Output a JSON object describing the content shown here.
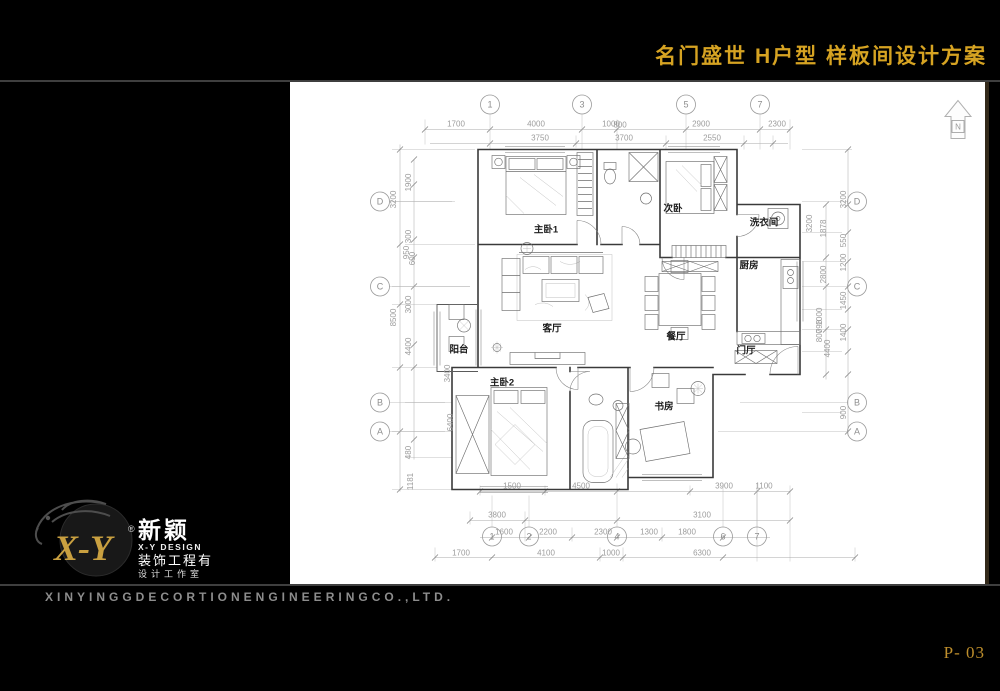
{
  "header": {
    "title": "名门盛世 H户型 样板间设计方案"
  },
  "footer": {
    "company_en": "XINYINGGDECORTIONENGINEERINGCO.,LTD.",
    "page_number": "P- 03"
  },
  "logo": {
    "xy": "X-Y",
    "reg": "®",
    "cn": "新颖",
    "design": "X-Y DESIGN",
    "line1": "装饰工程有",
    "line2": "设计工作室"
  },
  "plan": {
    "north_label": "N",
    "rooms": [
      {
        "label": "主卧1",
        "x": 546,
        "y": 233
      },
      {
        "label": "次卧",
        "x": 673,
        "y": 212
      },
      {
        "label": "洗衣间",
        "x": 764,
        "y": 226
      },
      {
        "label": "厨房",
        "x": 749,
        "y": 269
      },
      {
        "label": "客厅",
        "x": 552,
        "y": 332
      },
      {
        "label": "餐厅",
        "x": 676,
        "y": 340
      },
      {
        "label": "门厅",
        "x": 746,
        "y": 354
      },
      {
        "label": "阳台",
        "x": 459,
        "y": 353
      },
      {
        "label": "主卧2",
        "x": 502,
        "y": 386
      },
      {
        "label": "书房",
        "x": 664,
        "y": 410
      }
    ],
    "bubbles": [
      {
        "n": "1",
        "x": 490,
        "y": 105
      },
      {
        "n": "3",
        "x": 582,
        "y": 105
      },
      {
        "n": "5",
        "x": 686,
        "y": 105
      },
      {
        "n": "7",
        "x": 760,
        "y": 105
      },
      {
        "n": "1",
        "x": 492,
        "y": 537
      },
      {
        "n": "2",
        "x": 529,
        "y": 537
      },
      {
        "n": "4",
        "x": 617,
        "y": 537
      },
      {
        "n": "6",
        "x": 723,
        "y": 537
      },
      {
        "n": "7",
        "x": 757,
        "y": 537
      },
      {
        "n": "D",
        "x": 380,
        "y": 202
      },
      {
        "n": "C",
        "x": 380,
        "y": 287
      },
      {
        "n": "B",
        "x": 380,
        "y": 403
      },
      {
        "n": "A",
        "x": 380,
        "y": 432
      },
      {
        "n": "D",
        "x": 857,
        "y": 202
      },
      {
        "n": "C",
        "x": 857,
        "y": 287
      },
      {
        "n": "B",
        "x": 857,
        "y": 403
      },
      {
        "n": "A",
        "x": 857,
        "y": 432
      }
    ],
    "dims": [
      {
        "t": "1700",
        "x": 456,
        "y": 127
      },
      {
        "t": "4000",
        "x": 536,
        "y": 127
      },
      {
        "t": "1000",
        "x": 611,
        "y": 127
      },
      {
        "t": "800",
        "x": 620,
        "y": 128
      },
      {
        "t": "2900",
        "x": 701,
        "y": 127
      },
      {
        "t": "2300",
        "x": 777,
        "y": 127
      },
      {
        "t": "3750",
        "x": 540,
        "y": 141
      },
      {
        "t": "3700",
        "x": 624,
        "y": 141
      },
      {
        "t": "2550",
        "x": 712,
        "y": 141
      },
      {
        "t": "1500",
        "x": 512,
        "y": 489
      },
      {
        "t": "4500",
        "x": 581,
        "y": 489
      },
      {
        "t": "3900",
        "x": 724,
        "y": 489
      },
      {
        "t": "1100",
        "x": 764,
        "y": 489
      },
      {
        "t": "3800",
        "x": 497,
        "y": 518
      },
      {
        "t": "3100",
        "x": 702,
        "y": 518
      },
      {
        "t": "1600",
        "x": 504,
        "y": 535
      },
      {
        "t": "2200",
        "x": 548,
        "y": 535
      },
      {
        "t": "2300",
        "x": 603,
        "y": 535
      },
      {
        "t": "1300",
        "x": 649,
        "y": 535
      },
      {
        "t": "1800",
        "x": 687,
        "y": 535
      },
      {
        "t": "1700",
        "x": 461,
        "y": 556
      },
      {
        "t": "4100",
        "x": 546,
        "y": 556
      },
      {
        "t": "1000",
        "x": 611,
        "y": 556
      },
      {
        "t": "6300",
        "x": 702,
        "y": 556
      },
      {
        "t": "3200",
        "x": 396,
        "y": 200,
        "r": 1
      },
      {
        "t": "8500",
        "x": 396,
        "y": 318,
        "r": 1
      },
      {
        "t": "1900",
        "x": 411,
        "y": 183,
        "r": 1
      },
      {
        "t": "300",
        "x": 411,
        "y": 237,
        "r": 1
      },
      {
        "t": "950",
        "x": 409,
        "y": 253,
        "r": 1
      },
      {
        "t": "600",
        "x": 415,
        "y": 259,
        "r": 1
      },
      {
        "t": "3000",
        "x": 411,
        "y": 305,
        "r": 1
      },
      {
        "t": "4400",
        "x": 411,
        "y": 347,
        "r": 1
      },
      {
        "t": "3400",
        "x": 450,
        "y": 374,
        "r": 1
      },
      {
        "t": "6400",
        "x": 453,
        "y": 423,
        "r": 1
      },
      {
        "t": "480",
        "x": 411,
        "y": 453,
        "r": 1
      },
      {
        "t": "1181",
        "x": 413,
        "y": 482,
        "r": 1
      },
      {
        "t": "3200",
        "x": 846,
        "y": 200,
        "r": 1
      },
      {
        "t": "1878",
        "x": 826,
        "y": 229,
        "r": 1
      },
      {
        "t": "550",
        "x": 846,
        "y": 241,
        "r": 1
      },
      {
        "t": "1200",
        "x": 846,
        "y": 263,
        "r": 1
      },
      {
        "t": "2800",
        "x": 826,
        "y": 275,
        "r": 1
      },
      {
        "t": "1450",
        "x": 846,
        "y": 301,
        "r": 1
      },
      {
        "t": "1400",
        "x": 846,
        "y": 333,
        "r": 1
      },
      {
        "t": "1000",
        "x": 822,
        "y": 317,
        "r": 1
      },
      {
        "t": "798",
        "x": 822,
        "y": 327,
        "r": 1
      },
      {
        "t": "800",
        "x": 822,
        "y": 336,
        "r": 1
      },
      {
        "t": "4400",
        "x": 830,
        "y": 349,
        "r": 1
      },
      {
        "t": "900",
        "x": 846,
        "y": 413,
        "r": 1
      },
      {
        "t": "3200",
        "x": 812,
        "y": 224,
        "r": 1
      }
    ]
  }
}
